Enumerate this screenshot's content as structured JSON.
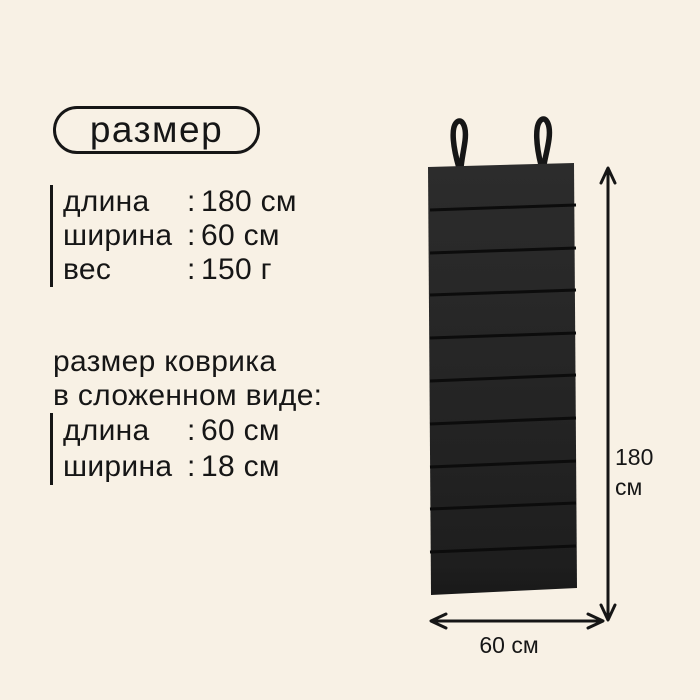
{
  "page": {
    "background": "#f8f1e5",
    "ink": "#161616",
    "mat_color": "#262626"
  },
  "title": "размер",
  "specs": {
    "rows": [
      {
        "label": "длина",
        "colon": ":",
        "value": "180 см"
      },
      {
        "label": "ширина",
        "colon": ":",
        "value": "60 см"
      },
      {
        "label": "вес",
        "colon": ":",
        "value": "150 г"
      }
    ]
  },
  "folded": {
    "heading_line1": "размер коврика",
    "heading_line2": "в сложенном виде:",
    "rows": [
      {
        "label": "длина",
        "colon": ":",
        "value": "60 см"
      },
      {
        "label": "ширина",
        "colon": ":",
        "value": "18 см"
      }
    ]
  },
  "diagram": {
    "height_value": "180",
    "height_unit": "см",
    "width_label": "60 см"
  }
}
